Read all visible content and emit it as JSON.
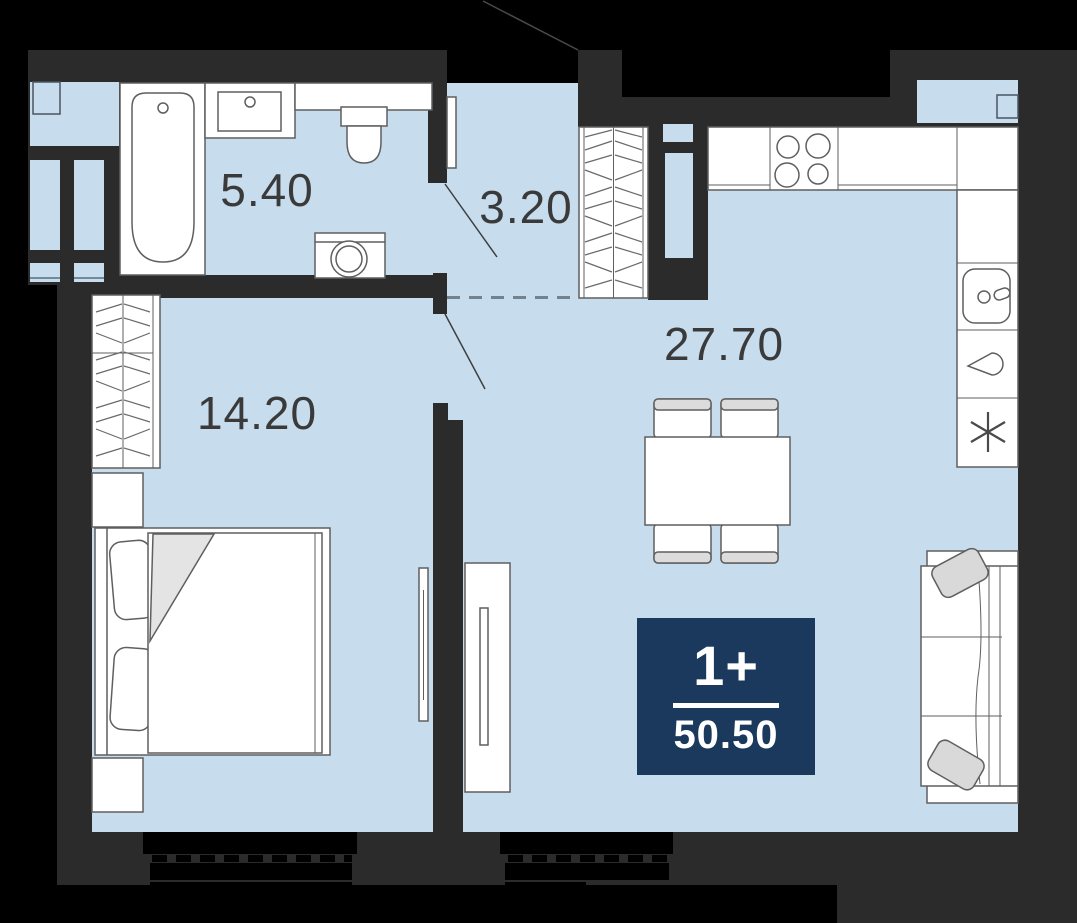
{
  "title": "Apartment floor plan 1+ 50.50 m2",
  "badge": {
    "type_label": "1+",
    "area_value": "50.50"
  },
  "rooms": {
    "bathroom": {
      "area": "5.40"
    },
    "hallway": {
      "area": "3.20"
    },
    "bedroom": {
      "area": "14.20"
    },
    "living_kitchen": {
      "area": "27.70"
    }
  },
  "colors": {
    "outside": "#000000",
    "wall": "#2b2b2b",
    "floor": "#c7dcec",
    "furniture_outline": "#5f5f5f",
    "badge_background": "#1a395c",
    "label_text": "#3a3a3a"
  },
  "furniture_icons": [
    "bathtub-icon",
    "bathroom-sink-icon",
    "toilet-icon",
    "washing-machine-icon",
    "hall-wardrobe-icon",
    "bedroom-wardrobe-icon",
    "bed-icon",
    "nightstand-icon",
    "tv-icon",
    "tv-console-icon",
    "dining-table-icon",
    "chair-icon",
    "kitchen-counter-icon",
    "stove-icon",
    "kitchen-sink-icon",
    "dishwasher-drop-icon",
    "fridge-asterisk-icon",
    "sofa-icon",
    "window-icon",
    "door-swing-icon"
  ]
}
